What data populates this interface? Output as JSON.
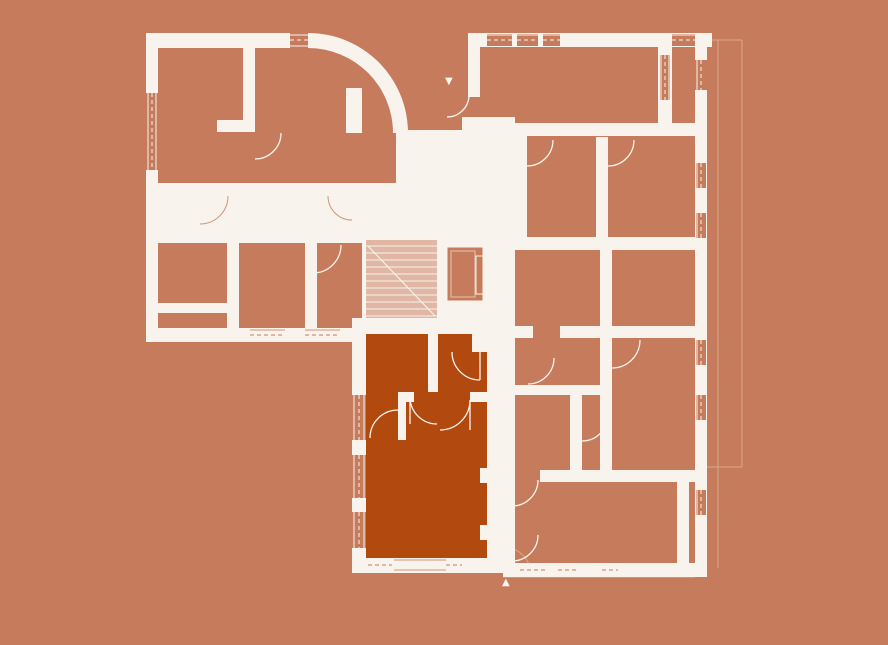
{
  "canvas": {
    "width": 888,
    "height": 645
  },
  "palette": {
    "background": "#c67c5c",
    "wall": "#f8f3ec",
    "highlight": "#b2490f",
    "faint": "#dba78c",
    "detail": "#cf9579"
  },
  "floor_plan": {
    "name": "building-floor-plan",
    "selected_unit": {
      "name": "selected-apartment",
      "fill": "#b2490f"
    },
    "markers": {
      "top_entrance": "▼",
      "bottom_entrance": "▲"
    }
  }
}
